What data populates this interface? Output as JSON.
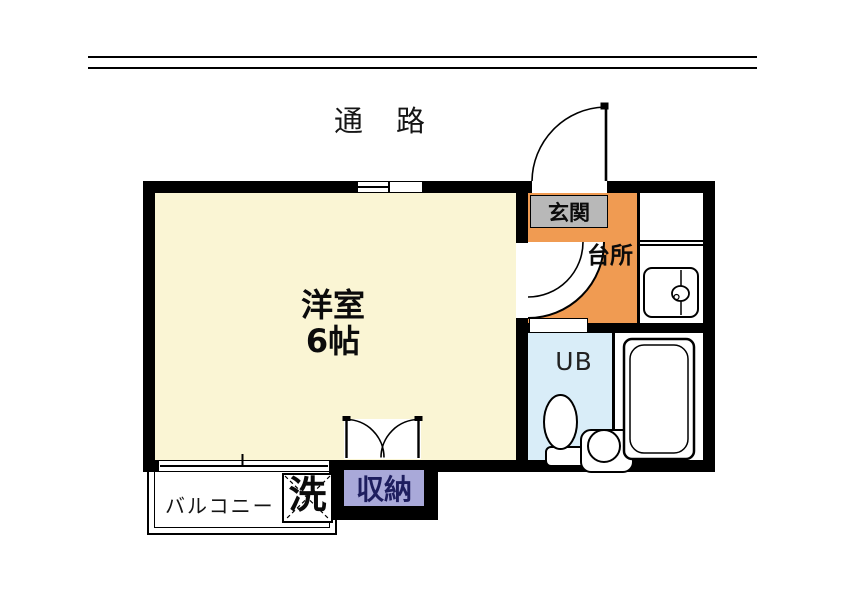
{
  "labels": {
    "corridor": "通　路",
    "room_name": "洋室",
    "room_size": "6帖",
    "entrance": "玄関",
    "kitchen": "台所",
    "unit_bath": "UB",
    "storage": "収納",
    "laundry": "洗",
    "balcony": "バルコニー"
  },
  "colors": {
    "wall": "#000000",
    "room_floor": "#FAF5D4",
    "kitchen_floor": "#F09B52",
    "entrance_floor": "#B8B8B8",
    "unit_bath_floor": "#D9EDF8",
    "storage_bg": "#A9A9D9",
    "storage_text": "#1E1E5F",
    "background": "#FFFFFF"
  }
}
